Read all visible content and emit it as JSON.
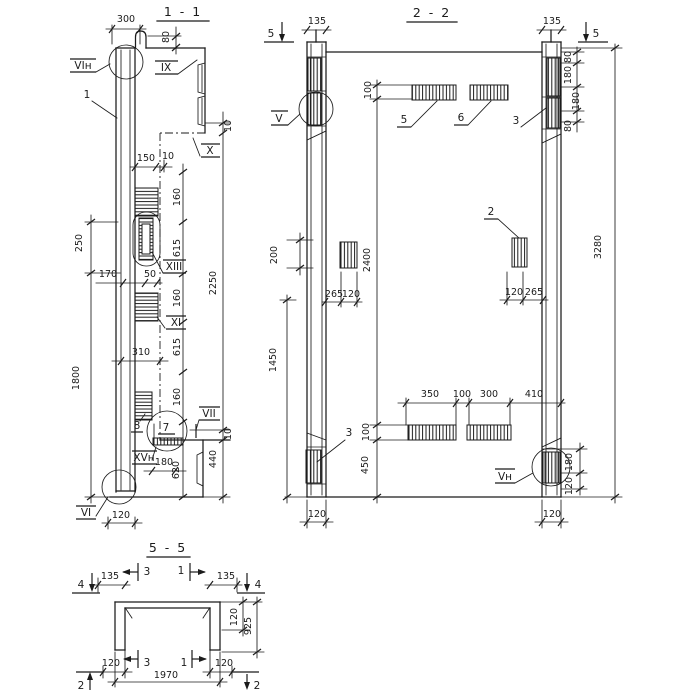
{
  "drawing": {
    "paper_color": "#ffffff",
    "ink_color": "#1b1b1b",
    "s11": {
      "title": "1 - 1",
      "labels": {
        "vi_top": "VIн",
        "item1": "1",
        "ix": "IX",
        "x": "X",
        "xiii": "XIII",
        "xi": "XI",
        "item8": "8",
        "item7": "7",
        "vii": "VII",
        "xvn": "XVн",
        "vi_bottom": "VI"
      },
      "dims": {
        "w300": "300",
        "h80": "80",
        "o10t": "10",
        "p150": "150",
        "g10": "10",
        "s160a": "160",
        "s615a": "615",
        "s160b": "160",
        "s615b": "615",
        "s160c": "160",
        "l250": "250",
        "l1800": "1800",
        "h170": "170",
        "h50": "50",
        "o2250": "2250",
        "h310": "310",
        "b180": "180",
        "b620": "620",
        "b440": "440",
        "o10b": "10",
        "b120": "120"
      }
    },
    "s22": {
      "title": "2 - 2",
      "labels": {
        "v": "V",
        "vn": "Vн",
        "item2": "2",
        "item3t": "3",
        "item3b": "3",
        "item5": "5",
        "item6": "6"
      },
      "cuts": {
        "c5l": "5",
        "c5r": "5"
      },
      "dims": {
        "t135l": "135",
        "t135r": "135",
        "p100t": "100",
        "r80a": "80",
        "r180a": "180",
        "r180b": "180",
        "r80b": "80",
        "o3280": "3280",
        "l200": "200",
        "c2400": "2400",
        "pl265": "265",
        "pl120": "120",
        "pr120": "120",
        "pr265": "265",
        "l1450": "1450",
        "b350": "350",
        "b100": "100",
        "b300": "300",
        "b410": "410",
        "c100b": "100",
        "c450": "450",
        "rb180": "180",
        "rb120": "120",
        "f120l": "120",
        "f120r": "120"
      }
    },
    "s55": {
      "title": "5 - 5",
      "cuts": {
        "c4l": "4",
        "c4r": "4",
        "c3t": "3",
        "c1t": "1",
        "c3b": "3",
        "c1b": "1",
        "c2l": "2",
        "c2r": "2"
      },
      "dims": {
        "t135l": "135",
        "t135r": "135",
        "r120": "120",
        "r925": "925",
        "b120l": "120",
        "b120r": "120",
        "w1970": "1970"
      }
    }
  }
}
